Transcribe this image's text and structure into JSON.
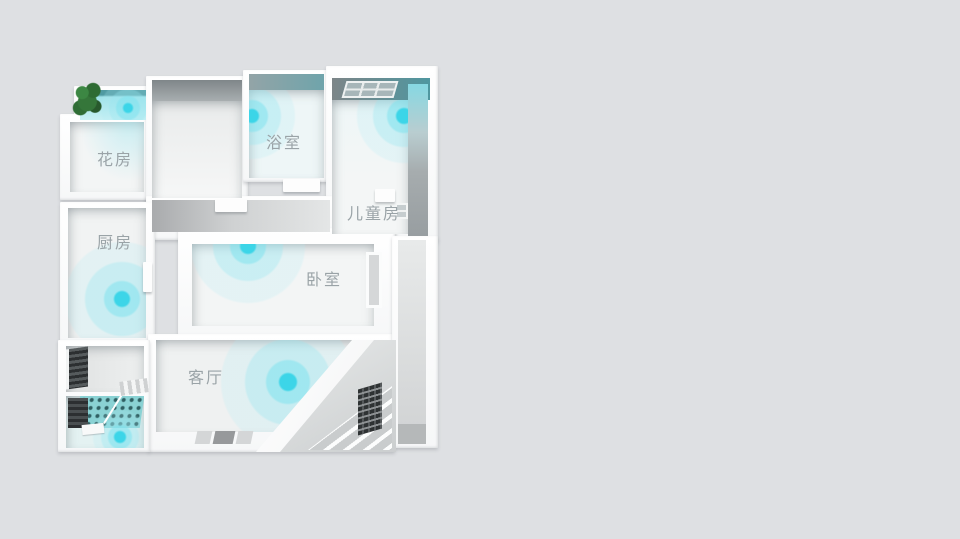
{
  "scene": {
    "type": "3d-floorplan-wifi-coverage",
    "background_color": "#dee0e3",
    "signal_count": 7
  },
  "rooms": [
    {
      "id": "flower-room",
      "label": "花房",
      "has_signal": true
    },
    {
      "id": "bathroom",
      "label": "浴室",
      "has_signal": true
    },
    {
      "id": "kids-room",
      "label": "儿童房",
      "has_signal": true
    },
    {
      "id": "kitchen",
      "label": "厨房",
      "has_signal": true
    },
    {
      "id": "bedroom",
      "label": "卧室",
      "has_signal": true
    },
    {
      "id": "living-room",
      "label": "客厅",
      "has_signal": true
    }
  ],
  "colors": {
    "signal_core": "#36d4e7",
    "signal_halo_mid": "#7ce2ee",
    "signal_halo_outer": "#b0eaf3",
    "label_text": "#9aa3a7",
    "wall": "#ffffff",
    "floor": "#f2f4f4",
    "balcony_floor": "#9fe2e9",
    "dark_teal_edge": "#4f9aa2",
    "plant_green": "#35763a"
  }
}
